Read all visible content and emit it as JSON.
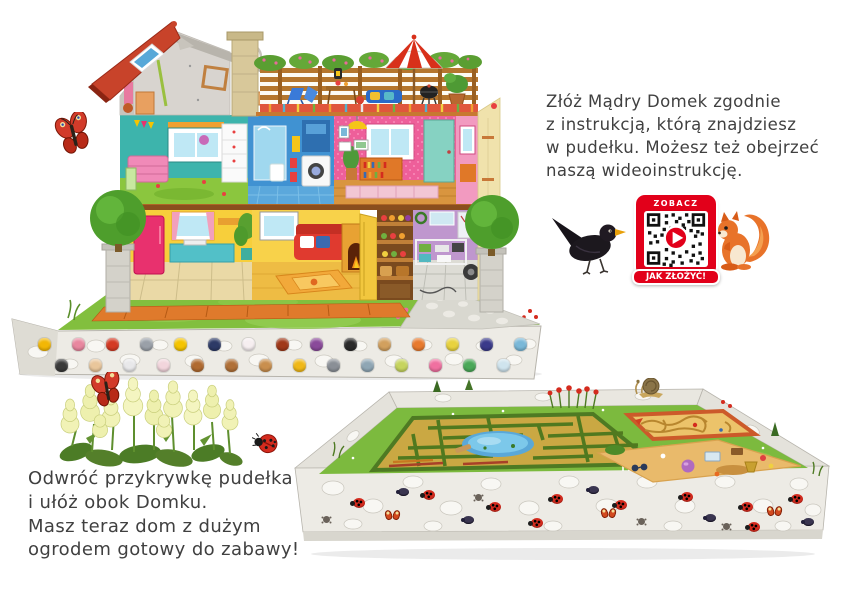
{
  "page": {
    "background": "#ffffff",
    "language": "pl"
  },
  "top_instruction": {
    "lines": [
      "Złóż Mądry Domek zgodnie",
      "z instrukcją, którą znajdziesz",
      "w pudełku. Możesz też obejrzeć",
      "naszą wideoinstrukcję."
    ]
  },
  "bottom_instruction": {
    "lines": [
      "Odwróć przykrywkę pudełka",
      "i ułóż obok Domku.",
      "Masz teraz dom z dużym",
      "ogrodem gotowy do zabawy!"
    ]
  },
  "qr_badge": {
    "top_label": "ZOBACZ",
    "bottom_label": "JAK ZŁOŻYĆ!",
    "frame_color": "#e2001a"
  },
  "illustrations": {
    "dollhouse": "cross-section dollhouse on stone garden base with two topiary trees",
    "garden_box": "inverted box lid with hedge maze, pond, sand maze and sandbox",
    "animals": [
      "peacock-butterfly",
      "blackbird",
      "red-squirrel",
      "snail",
      "ladybug"
    ],
    "flowers": "cream hydrangea clump with butterfly and ladybug"
  },
  "colors": {
    "roof_red": "#c8432a",
    "kids_room": "#3db4ac",
    "bathroom": "#4092d2",
    "bedroom": "#ee5f9a",
    "kitchen": "#f7cf3b",
    "garage": "#bf97ce",
    "lawn": "#82bf3e",
    "stone": "#edebe5",
    "accent_red": "#e2001a"
  },
  "house_base_objects": [
    {
      "name": "alarm-clock",
      "x": 30,
      "y": 330,
      "color": "#f2b705"
    },
    {
      "name": "spider",
      "x": 47,
      "y": 351,
      "color": "#3a3a3a"
    },
    {
      "name": "flower-bouquet",
      "x": 64,
      "y": 330,
      "color": "#e8879f"
    },
    {
      "name": "eggs",
      "x": 81,
      "y": 351,
      "color": "#e9c69b"
    },
    {
      "name": "butterfly",
      "x": 98,
      "y": 330,
      "color": "#d43a24"
    },
    {
      "name": "paint-palette",
      "x": 115,
      "y": 351,
      "color": "#e8e8ea"
    },
    {
      "name": "scissors",
      "x": 132,
      "y": 330,
      "color": "#9aa0a8"
    },
    {
      "name": "paint-roller",
      "x": 149,
      "y": 351,
      "color": "#f2d5dc"
    },
    {
      "name": "duck",
      "x": 166,
      "y": 330,
      "color": "#f5c400"
    },
    {
      "name": "bowl",
      "x": 183,
      "y": 351,
      "color": "#b06a30"
    },
    {
      "name": "name-plate",
      "x": 200,
      "y": 330,
      "color": "#2d3a66"
    },
    {
      "name": "teddy-bear",
      "x": 217,
      "y": 351,
      "color": "#b07038"
    },
    {
      "name": "slippers",
      "x": 234,
      "y": 330,
      "color": "#f6eef0"
    },
    {
      "name": "wooden-spoon",
      "x": 251,
      "y": 351,
      "color": "#c98f4e"
    },
    {
      "name": "firewood-box",
      "x": 268,
      "y": 330,
      "color": "#a03818"
    },
    {
      "name": "birdhouse",
      "x": 285,
      "y": 351,
      "color": "#f0b818"
    },
    {
      "name": "jam-jar",
      "x": 302,
      "y": 330,
      "color": "#8a4a9a"
    },
    {
      "name": "pliers",
      "x": 319,
      "y": 351,
      "color": "#8a8f96"
    },
    {
      "name": "lantern",
      "x": 336,
      "y": 330,
      "color": "#2a2a2a"
    },
    {
      "name": "watering-can",
      "x": 353,
      "y": 351,
      "color": "#8fa6b4"
    },
    {
      "name": "rocking-horse",
      "x": 370,
      "y": 330,
      "color": "#d2a05e"
    },
    {
      "name": "mitten",
      "x": 387,
      "y": 351,
      "color": "#c6d45e"
    },
    {
      "name": "squirrel-figure",
      "x": 404,
      "y": 330,
      "color": "#e87a2e"
    },
    {
      "name": "umbrella-toy",
      "x": 421,
      "y": 351,
      "color": "#f070a0"
    },
    {
      "name": "pear",
      "x": 438,
      "y": 330,
      "color": "#e8d23e"
    },
    {
      "name": "table-lamp",
      "x": 455,
      "y": 351,
      "color": "#4aa858"
    },
    {
      "name": "guitar",
      "x": 472,
      "y": 330,
      "color": "#3a3a8a"
    },
    {
      "name": "tennis-racket",
      "x": 489,
      "y": 351,
      "color": "#cfe4ee"
    },
    {
      "name": "postcard",
      "x": 506,
      "y": 330,
      "color": "#7ab8d8"
    }
  ],
  "garden_bugs": [
    {
      "type": "ladybug",
      "x": 60,
      "y": 120
    },
    {
      "type": "beetle",
      "x": 105,
      "y": 110
    },
    {
      "type": "butterfly",
      "x": 92,
      "y": 132
    },
    {
      "type": "ladybug",
      "x": 130,
      "y": 112
    },
    {
      "type": "spider",
      "x": 30,
      "y": 138
    },
    {
      "type": "ladybug",
      "x": 196,
      "y": 124
    },
    {
      "type": "beetle",
      "x": 170,
      "y": 138
    },
    {
      "type": "spider",
      "x": 182,
      "y": 116
    },
    {
      "type": "ladybug",
      "x": 258,
      "y": 116
    },
    {
      "type": "butterfly",
      "x": 308,
      "y": 130
    },
    {
      "type": "beetle",
      "x": 295,
      "y": 108
    },
    {
      "type": "ladybug",
      "x": 322,
      "y": 122
    },
    {
      "type": "ladybug",
      "x": 238,
      "y": 140
    },
    {
      "type": "spider",
      "x": 345,
      "y": 140
    },
    {
      "type": "ladybug",
      "x": 388,
      "y": 114
    },
    {
      "type": "beetle",
      "x": 412,
      "y": 136
    },
    {
      "type": "ladybug",
      "x": 448,
      "y": 124
    },
    {
      "type": "butterfly",
      "x": 474,
      "y": 128
    },
    {
      "type": "ladybug",
      "x": 498,
      "y": 116
    },
    {
      "type": "beetle",
      "x": 510,
      "y": 140
    },
    {
      "type": "spider",
      "x": 430,
      "y": 145
    },
    {
      "type": "ladybug",
      "x": 455,
      "y": 144
    }
  ]
}
